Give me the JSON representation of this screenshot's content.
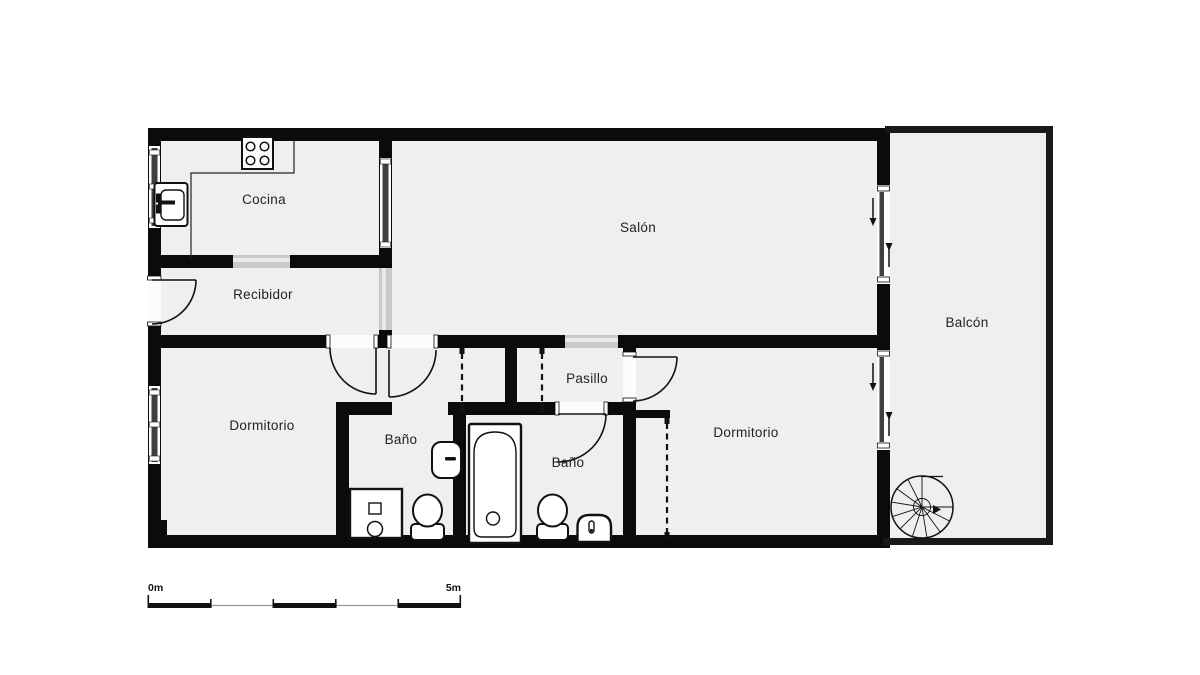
{
  "plan": {
    "rooms": {
      "cocina": {
        "label": "Cocina"
      },
      "recibidor": {
        "label": "Recibidor"
      },
      "salon": {
        "label": "Salón"
      },
      "balcon": {
        "label": "Balcón"
      },
      "dormitorio_izq": {
        "label": "Dormitorio"
      },
      "bano_1": {
        "label": "Baño"
      },
      "pasillo": {
        "label": "Pasillo"
      },
      "bano_2": {
        "label": "Baño"
      },
      "dormitorio_der": {
        "label": "Dormitorio"
      }
    },
    "scale_bar": {
      "start": "0m",
      "end": "5m"
    },
    "colors": {
      "wall": "#0b0b0b",
      "balcony_wall": "#191919",
      "floor": "#efefef",
      "passage": "#c9c9c9",
      "window_glass": "#3f3f3f",
      "background": "#ffffff"
    },
    "icons": [
      "stove-icon",
      "kitchen-sink-icon",
      "shower-unit-icon",
      "toilet-icon",
      "washbasin-icon",
      "bathtub-icon",
      "bidet-icon",
      "spiral-staircase-icon",
      "sliding-door-arrow-icon",
      "door-swing-arc",
      "wardrobe-dashed-doors",
      "window-strip",
      "scale-bar"
    ]
  }
}
